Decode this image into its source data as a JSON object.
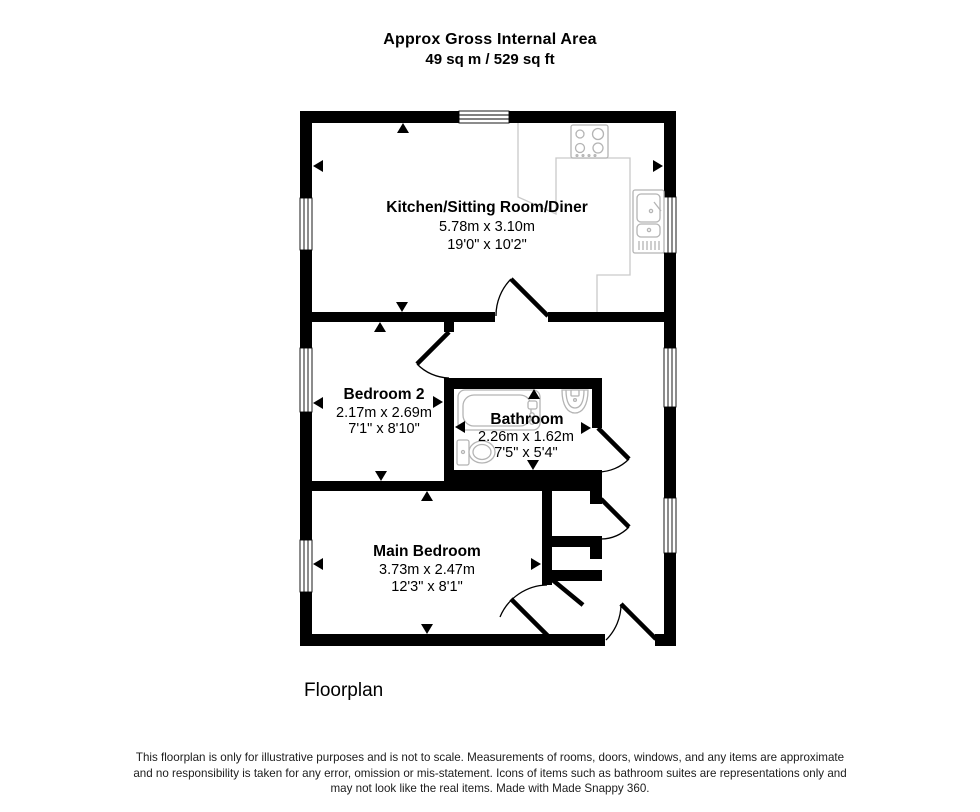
{
  "header": {
    "title": "Approx Gross Internal Area",
    "area": "49 sq m / 529 sq ft"
  },
  "rooms": [
    {
      "name": "Kitchen/Sitting Room/Diner",
      "metric": "5.78m x 3.10m",
      "imperial": "19'0\" x 10'2\""
    },
    {
      "name": "Bedroom 2",
      "metric": "2.17m x 2.69m",
      "imperial": "7'1\" x 8'10\""
    },
    {
      "name": "Bathroom",
      "metric": "2.26m x 1.62m",
      "imperial": "7'5\" x 5'4\""
    },
    {
      "name": "Main Bedroom",
      "metric": "3.73m x 2.47m",
      "imperial": "12'3\" x 8'1\""
    }
  ],
  "footer": {
    "caption": "Floorplan",
    "disclaimer_line1": "This floorplan is only for illustrative purposes and is not to scale. Measurements of rooms, doors, windows, and any items are approximate",
    "disclaimer_line2": "and no responsibility is taken for any error, omission or mis-statement. Icons of items such as bathroom suites are representations only and",
    "disclaimer_line3": "may not look like the real items. Made with Made Snappy 360."
  },
  "colors": {
    "wall": "#000000",
    "fixture_outline": "#b4b4b4",
    "worktop_outline": "#c9c9c9",
    "background": "#ffffff"
  }
}
